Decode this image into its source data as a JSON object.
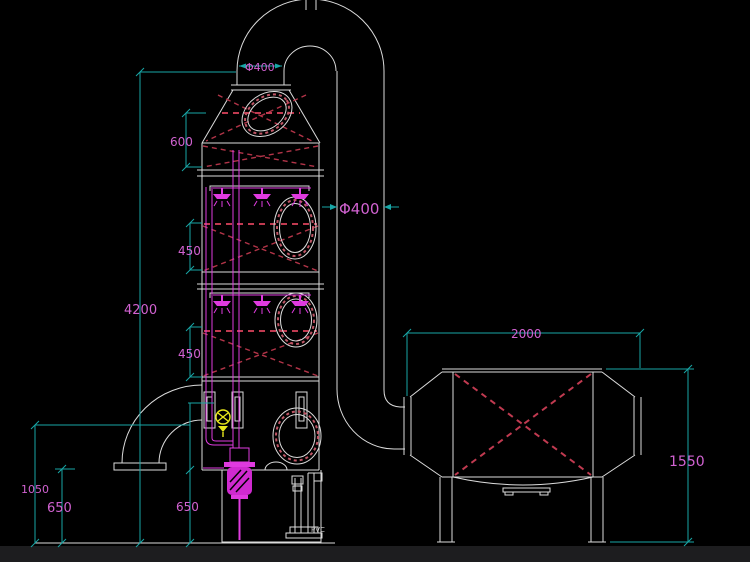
{
  "colors": {
    "background": "#000000",
    "outline_white": "#dcdcdc",
    "dimension_cyan": "#18a6a6",
    "label_magenta": "#d162d1",
    "pipe_magenta": "#e03ce0",
    "hatch_red": "#b23448",
    "valve_yellow": "#e9e91c"
  },
  "dimensions": {
    "stack_diameter": "Φ400",
    "duct_diameter": "Φ400",
    "cone_section_height": "600",
    "packing_section_1_height": "450",
    "packing_section_2_height": "450",
    "tower_overall_height": "4200",
    "drain_outlet_height": "1050",
    "drain_left_clearance": "650",
    "drain_right_clearance": "650",
    "adsorber_length": "2000",
    "adsorber_height": "1550"
  },
  "annotations": {
    "pump_text": "PVC"
  }
}
